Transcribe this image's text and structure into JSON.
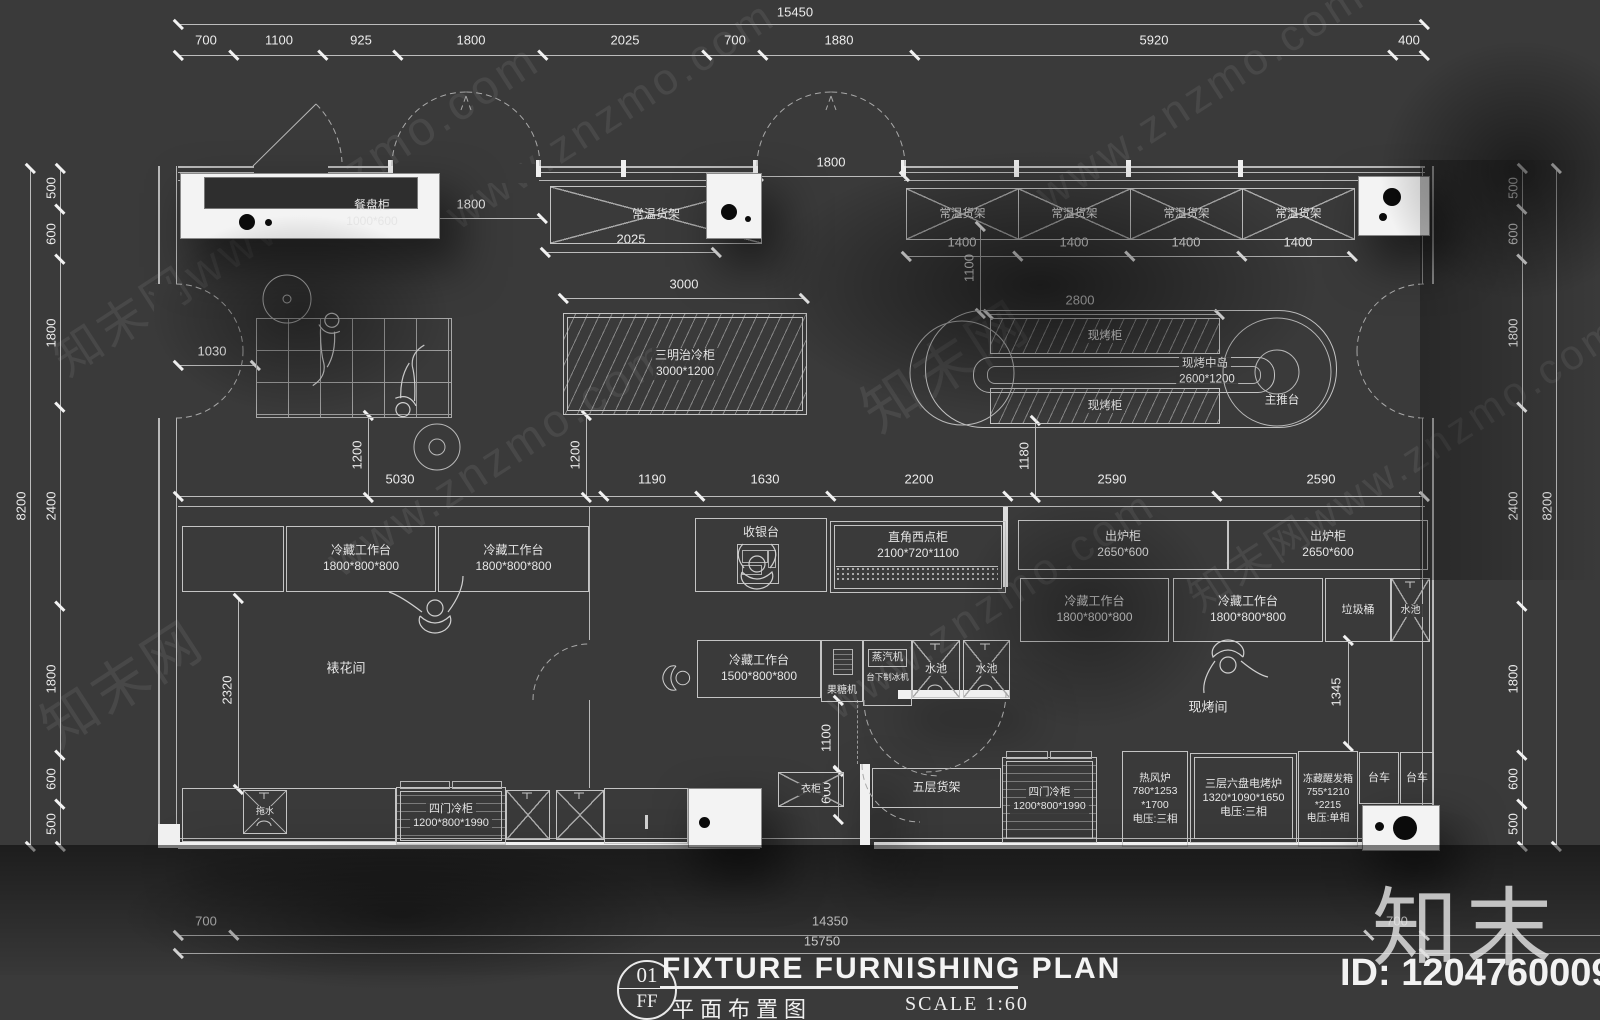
{
  "colors": {
    "bg": "#3a3a3a",
    "line": "#c6c6c6",
    "wall_white": "#f3f3f3",
    "text": "#e5e5e5"
  },
  "watermarks": {
    "logo": "知末",
    "id_text": "ID: 1204760009",
    "diag": [
      "www.znzmo.com",
      "知末网www.znzmo.com",
      "知末网"
    ]
  },
  "titleblock": {
    "num": "01",
    "code": "FF",
    "title_en": "FIXTURE FURNISHING PLAN",
    "title_cn": "平面布置图",
    "scale": "SCALE 1:60"
  },
  "dims": {
    "top_total": "15450",
    "top": [
      "700",
      "1100",
      "925",
      "1800",
      "2025",
      "700",
      "1880",
      "5920",
      "400"
    ],
    "side_total_left": "8200",
    "side_total_right": "8200",
    "left": [
      "500",
      "600",
      "1800",
      "2400",
      "1800",
      "600",
      "500"
    ],
    "right": [
      "500",
      "600",
      "1800",
      "2400",
      "1800",
      "600",
      "500"
    ],
    "mid": [
      "5030",
      "1190",
      "1630",
      "2200",
      "2590",
      "2590"
    ],
    "bottom": [
      "700",
      "14350",
      "700"
    ],
    "bottom_total": "15750",
    "inner": {
      "a1800": "1800",
      "a2025": "2025",
      "b1800": "1800",
      "c1400": "1400",
      "v1100": "1100",
      "a3000": "3000",
      "a2800": "2800",
      "a1030": "1030",
      "v1200a": "1200",
      "v1200b": "1200",
      "v1180": "1180",
      "v2320": "2320",
      "v1100b": "1100",
      "v600": "600",
      "v1345": "1345"
    }
  },
  "labels": {
    "canpangui": [
      "餐盘柜",
      "1000*600"
    ],
    "changwen": "常温货架",
    "sandwich": [
      "三明治冷柜",
      "3000*1200"
    ],
    "xiankaogui": "现烤柜",
    "island": [
      "现烤中岛",
      "2600*1200"
    ],
    "zhutai": "主推台",
    "lengcang1800": [
      "冷藏工作台",
      "1800*800*800"
    ],
    "lengcang1500": [
      "冷藏工作台",
      "1500*800*800"
    ],
    "room_biaohua": "裱花间",
    "room_xiankao": "现烤间",
    "cashier": "收银台",
    "xidiangui": [
      "直角西点柜",
      "2100*720*1100"
    ],
    "guotangji": "果糖机",
    "zhengqiji": "蒸汽机",
    "zhibingji": "台下制冰机",
    "shuichi": "水池",
    "chulugui": [
      "出炉柜",
      "2650*600"
    ],
    "lajitong": "垃圾桶",
    "refenglu": [
      "热风炉",
      "780*1253",
      "*1700",
      "电压:三相"
    ],
    "kaolu": [
      "三层六盘电烤炉",
      "1320*1090*1650",
      "电压:三相"
    ],
    "xingfaxiang": [
      "冻藏醒发箱",
      "755*1210",
      "*2215",
      "电压:单相"
    ],
    "taiche": "台车",
    "simenlenggui": [
      "四门冷柜",
      "1200*800*1990"
    ],
    "yigui": "衣柜",
    "wucenghuojia": "五层货架",
    "tuoshui": "拖水"
  }
}
